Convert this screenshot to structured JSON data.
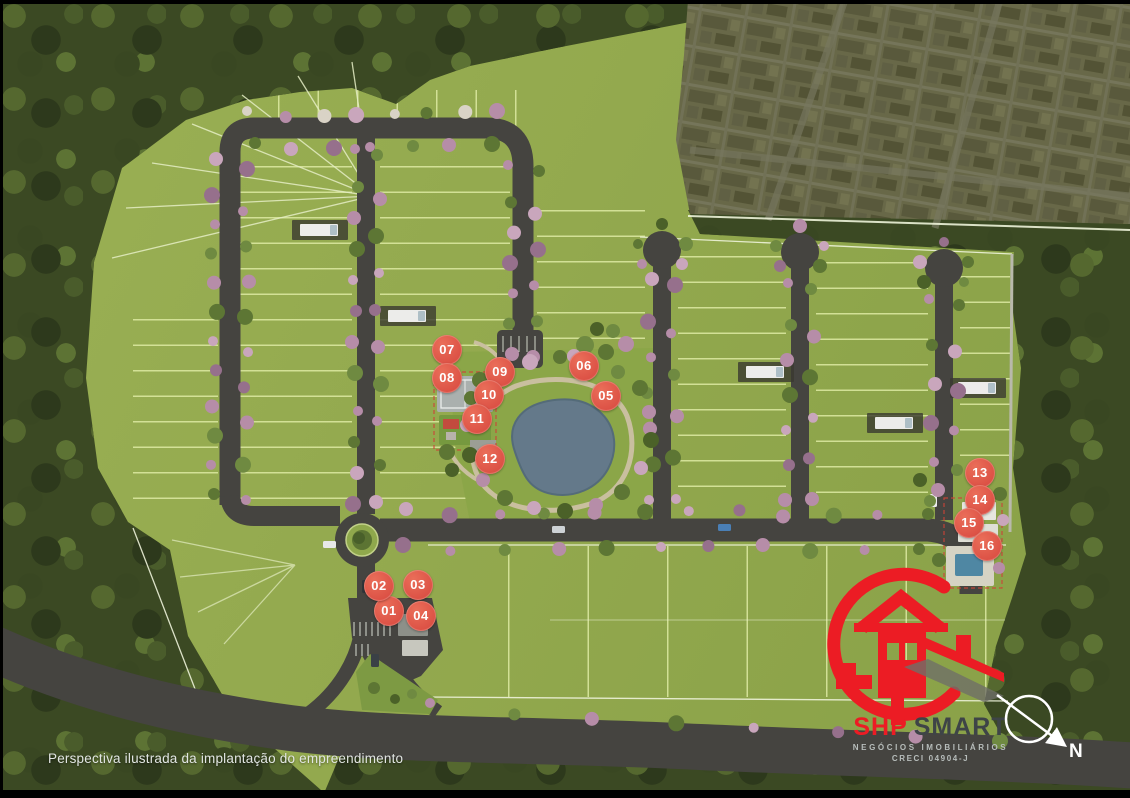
{
  "plan": {
    "caption": "Perspectiva ilustrada da implantação do empreendimento",
    "marker_color": "#dc5145",
    "markers": [
      {
        "label": "01",
        "x": 389,
        "y": 611
      },
      {
        "label": "02",
        "x": 379,
        "y": 586
      },
      {
        "label": "03",
        "x": 418,
        "y": 585
      },
      {
        "label": "04",
        "x": 421,
        "y": 616
      },
      {
        "label": "05",
        "x": 606,
        "y": 396
      },
      {
        "label": "06",
        "x": 584,
        "y": 366
      },
      {
        "label": "07",
        "x": 447,
        "y": 350
      },
      {
        "label": "08",
        "x": 447,
        "y": 378
      },
      {
        "label": "09",
        "x": 500,
        "y": 372
      },
      {
        "label": "10",
        "x": 489,
        "y": 395
      },
      {
        "label": "11",
        "x": 477,
        "y": 419
      },
      {
        "label": "12",
        "x": 490,
        "y": 459
      },
      {
        "label": "13",
        "x": 980,
        "y": 473
      },
      {
        "label": "14",
        "x": 980,
        "y": 500
      },
      {
        "label": "15",
        "x": 969,
        "y": 523
      },
      {
        "label": "16",
        "x": 987,
        "y": 546
      }
    ]
  },
  "logo": {
    "brand_primary": "SHP",
    "brand_secondary": "SMART",
    "tagline": "NEGÓCIOS IMOBILIÁRIOS",
    "license": "CRECI 04904-J",
    "accent_color": "#ec1c24"
  },
  "compass": {
    "label": "N"
  }
}
